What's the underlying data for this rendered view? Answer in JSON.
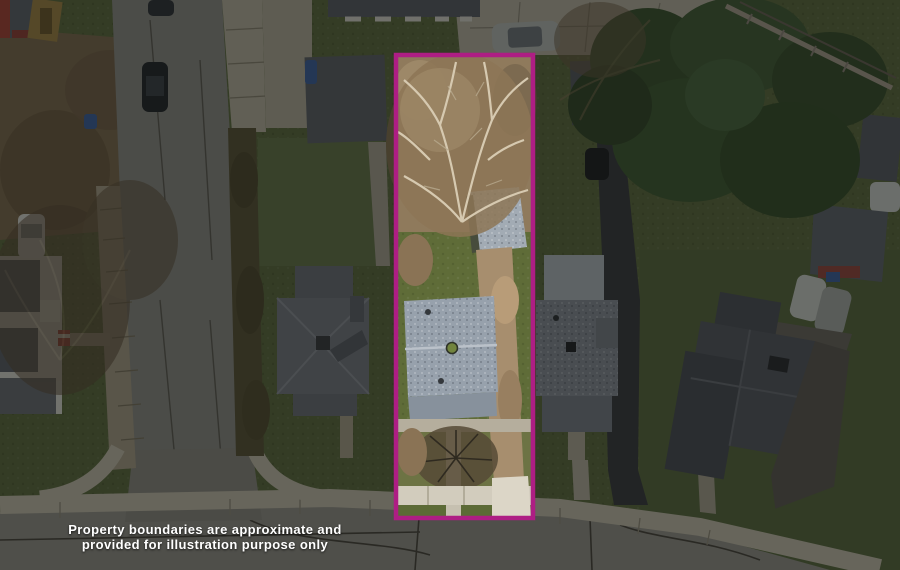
{
  "scene": {
    "type": "aerial-drone-photo",
    "subject": "residential property with highlighted lot"
  },
  "boundary": {
    "color": "#AE1E84",
    "x": 396,
    "y": 55,
    "width": 137,
    "height": 463
  },
  "disclaimer": {
    "line1": "Property boundaries are approximate and",
    "line2": "provided for illustration purpose only",
    "text_color": "#FFFFFF"
  }
}
